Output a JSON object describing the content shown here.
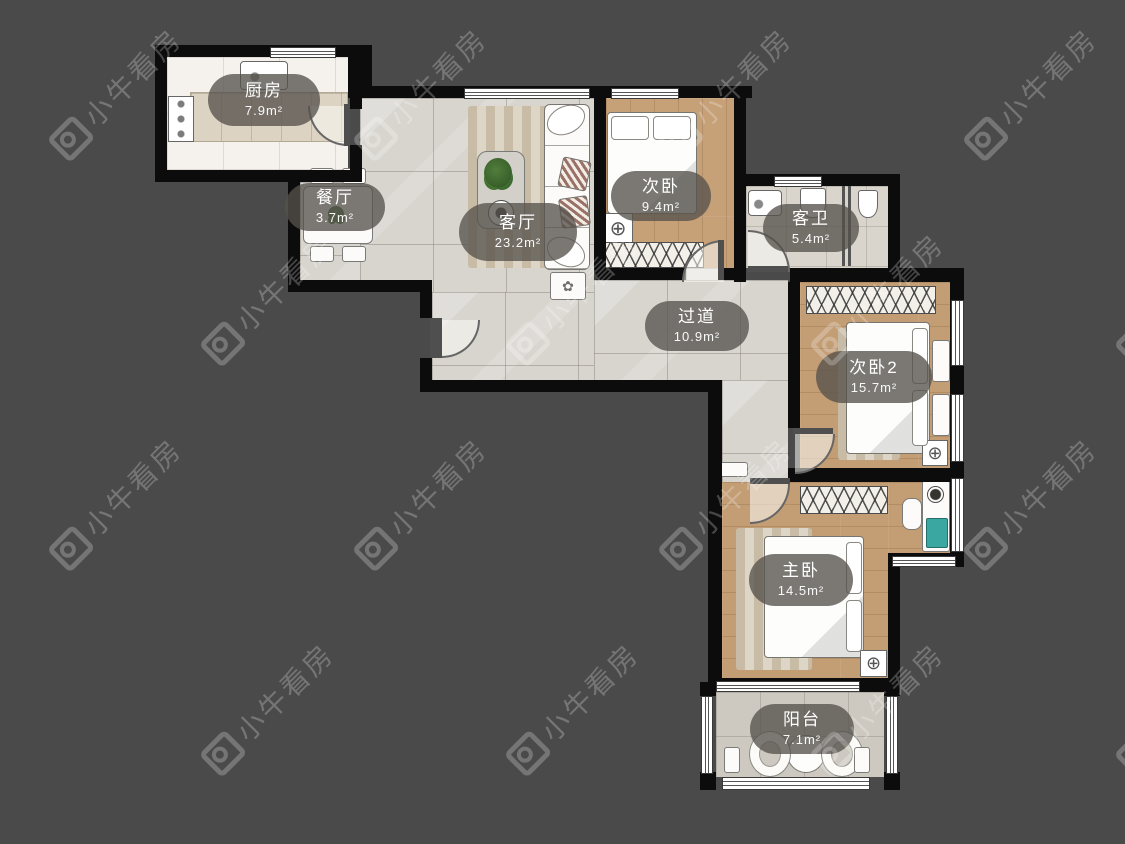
{
  "watermark": {
    "text": "小牛看房",
    "icon": "niuniu-camera-logo"
  },
  "rooms": [
    {
      "key": "kitchen",
      "name": "厨房",
      "area": "7.9m²"
    },
    {
      "key": "dining",
      "name": "餐厅",
      "area": "3.7m²"
    },
    {
      "key": "living",
      "name": "客厅",
      "area": "23.2m²"
    },
    {
      "key": "bedroom_a",
      "name": "次卧",
      "area": "9.4m²"
    },
    {
      "key": "bathroom",
      "name": "客卫",
      "area": "5.4m²"
    },
    {
      "key": "hallway",
      "name": "过道",
      "area": "10.9m²"
    },
    {
      "key": "bedroom_b",
      "name": "次卧2",
      "area": "15.7m²"
    },
    {
      "key": "master",
      "name": "主卧",
      "area": "14.5m²"
    },
    {
      "key": "balcony",
      "name": "阳台",
      "area": "7.1m²"
    }
  ],
  "icons": {
    "ceiling_light": "⊕",
    "flower": "✿"
  },
  "colors": {
    "background": "#4a4a4a",
    "wall": "#0c0c0c",
    "label_pill": "rgba(86,82,77,0.78)",
    "wood": "#c6a077",
    "tile": "#d8d5cf",
    "laptop_accent": "#3aa7a0"
  }
}
